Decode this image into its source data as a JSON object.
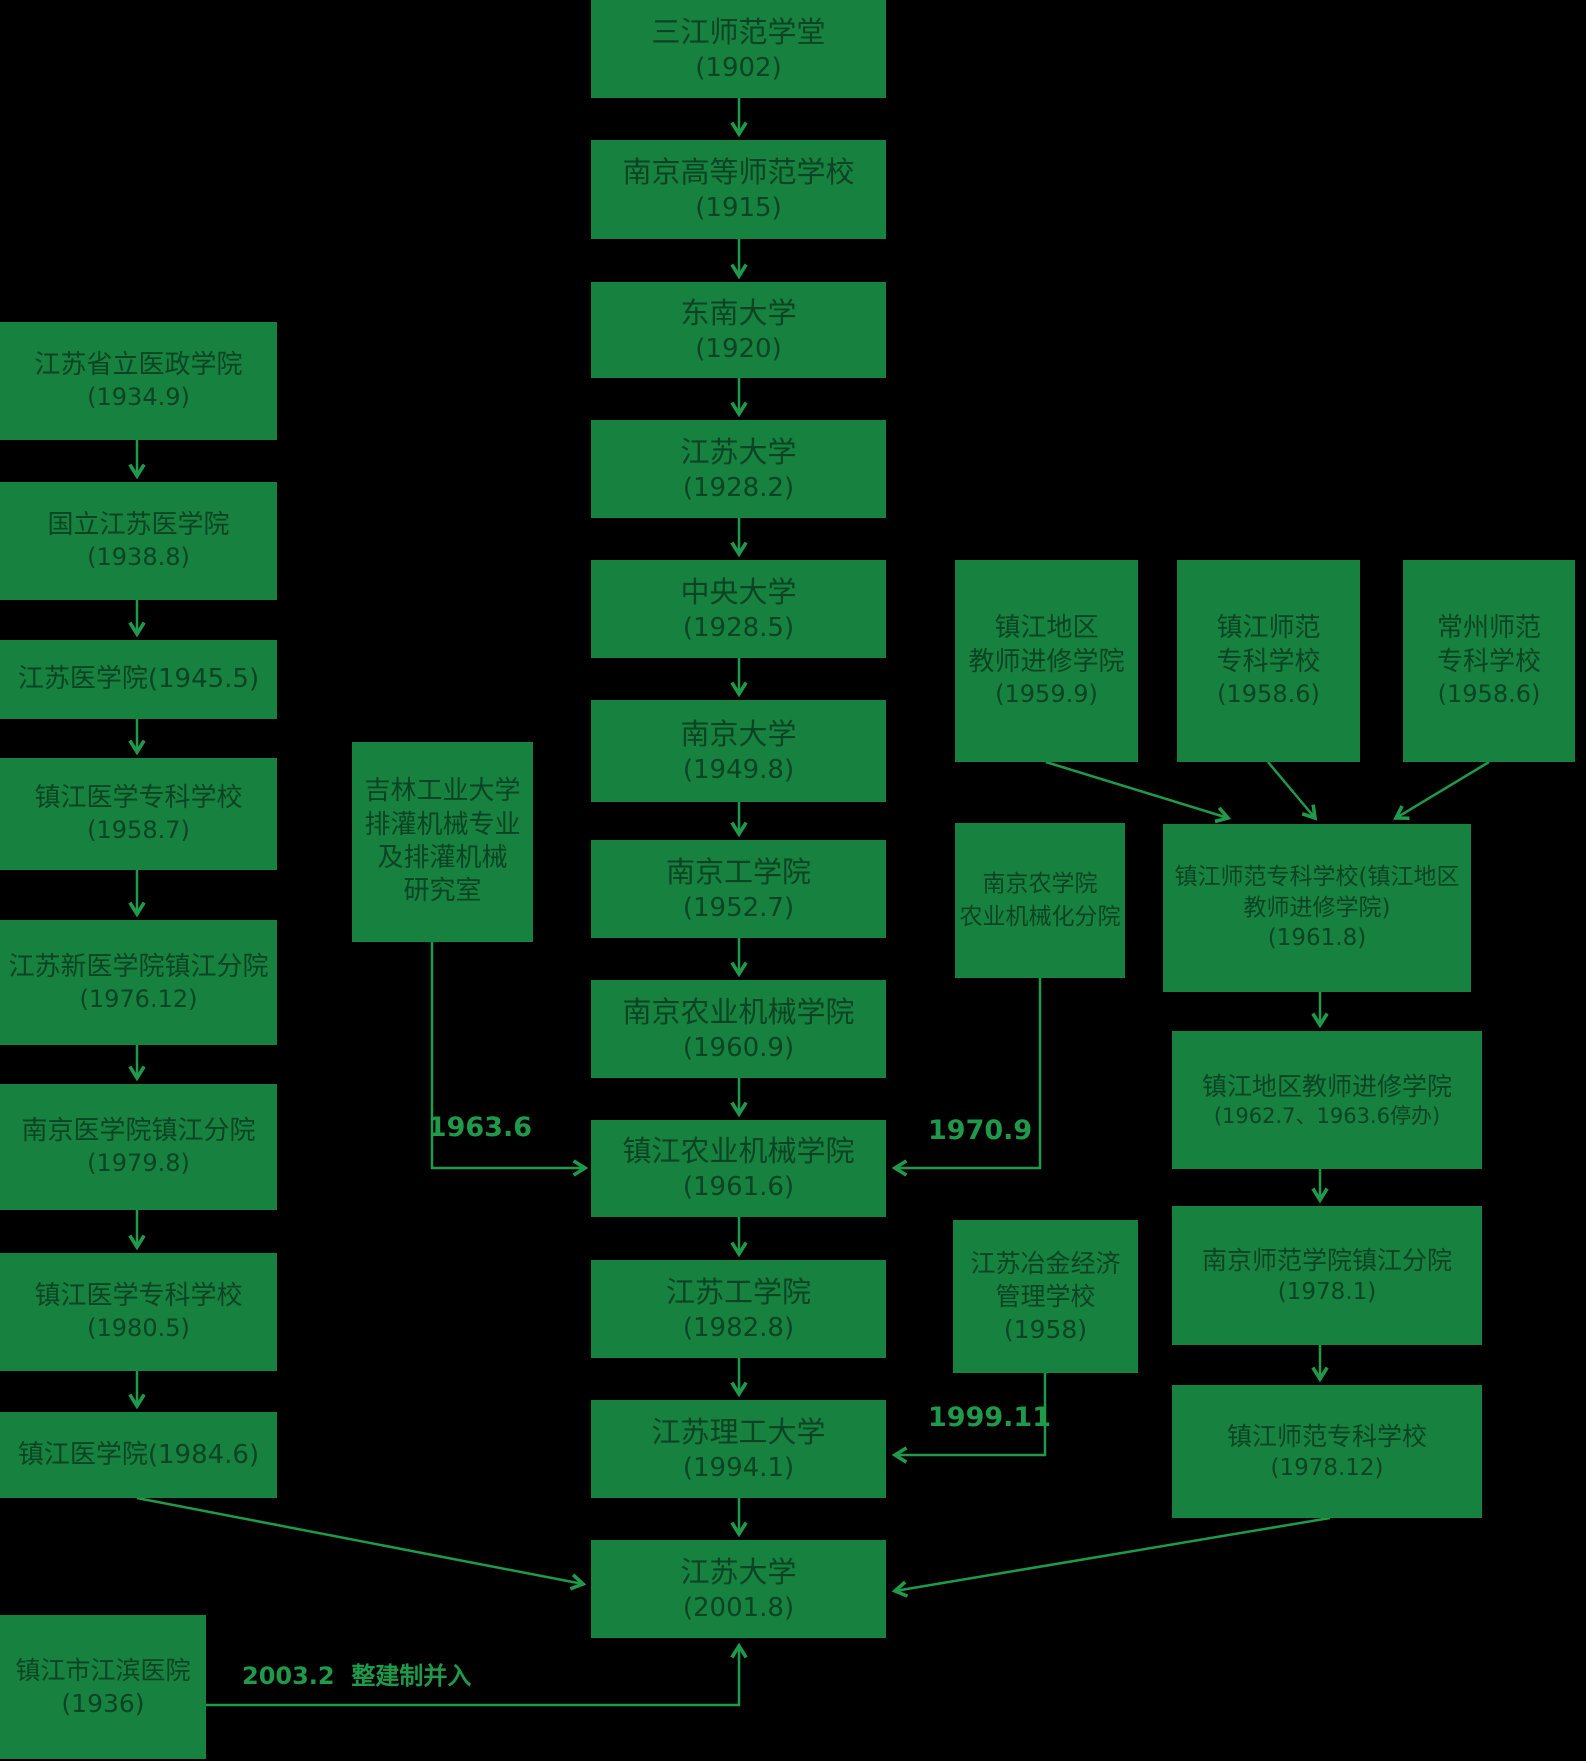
{
  "colors": {
    "background": "#000000",
    "box_fill": "#17813F",
    "box_text": "#0B4423",
    "line_and_label": "#1F9A4A"
  },
  "labels": {
    "merge_1963": "1963.6",
    "merge_1970": "1970.9",
    "merge_1999": "1999.11",
    "merge_2003": "2003.2  整建制并入"
  },
  "nodes": {
    "c1": {
      "lines": [
        "三江师范学堂",
        "(1902)"
      ]
    },
    "c2": {
      "lines": [
        "南京高等师范学校",
        "(1915)"
      ]
    },
    "c3": {
      "lines": [
        "东南大学",
        "(1920)"
      ]
    },
    "c4": {
      "lines": [
        "江苏大学",
        "(1928.2)"
      ]
    },
    "c5": {
      "lines": [
        "中央大学",
        "(1928.5)"
      ]
    },
    "c6": {
      "lines": [
        "南京大学",
        "(1949.8)"
      ]
    },
    "c7": {
      "lines": [
        "南京工学院",
        "(1952.7)"
      ]
    },
    "c8": {
      "lines": [
        "南京农业机械学院",
        "(1960.9)"
      ]
    },
    "c9": {
      "lines": [
        "镇江农业机械学院",
        "(1961.6)"
      ]
    },
    "c10": {
      "lines": [
        "江苏工学院",
        "(1982.8)"
      ]
    },
    "c11": {
      "lines": [
        "江苏理工大学",
        "(1994.1)"
      ]
    },
    "c12": {
      "lines": [
        "江苏大学",
        "(2001.8)"
      ]
    },
    "l1": {
      "lines": [
        "江苏省立医政学院",
        "(1934.9)"
      ]
    },
    "l2": {
      "lines": [
        "国立江苏医学院",
        "(1938.8)"
      ]
    },
    "l3": {
      "lines": [
        "江苏医学院(1945.5)"
      ]
    },
    "l4": {
      "lines": [
        "镇江医学专科学校",
        "(1958.7)"
      ]
    },
    "l5": {
      "lines": [
        "江苏新医学院镇江分院",
        "(1976.12)"
      ]
    },
    "l6": {
      "lines": [
        "南京医学院镇江分院",
        "(1979.8)"
      ]
    },
    "l7": {
      "lines": [
        "镇江医学专科学校",
        "(1980.5)"
      ]
    },
    "l8": {
      "lines": [
        "镇江医学院(1984.6)"
      ]
    },
    "lb": {
      "lines": [
        "镇江市江滨医院",
        "(1936)"
      ]
    },
    "jl": {
      "lines": [
        "吉林工业大学",
        "排灌机械专业",
        "及排灌机械",
        "研究室"
      ]
    },
    "nn": {
      "lines": [
        "南京农学院",
        "农业机械化分院"
      ]
    },
    "yj": {
      "lines": [
        "江苏冶金经济",
        "管理学校",
        "(1958)"
      ]
    },
    "rt1": {
      "lines": [
        "镇江地区",
        "教师进修学院",
        "(1959.9)"
      ]
    },
    "rt2": {
      "lines": [
        "镇江师范",
        "专科学校",
        "(1958.6)"
      ]
    },
    "rt3": {
      "lines": [
        "常州师范",
        "专科学校",
        "(1958.6)"
      ]
    },
    "r1": {
      "lines": [
        "镇江师范专科学校(镇江地区",
        "教师进修学院)",
        "(1961.8)"
      ]
    },
    "r2": {
      "lines": [
        "镇江地区教师进修学院",
        "(1962.7、1963.6停办)"
      ]
    },
    "r3": {
      "lines": [
        "南京师范学院镇江分院",
        "(1978.1)"
      ]
    },
    "r4": {
      "lines": [
        "镇江师范专科学校",
        "(1978.12)"
      ]
    }
  }
}
